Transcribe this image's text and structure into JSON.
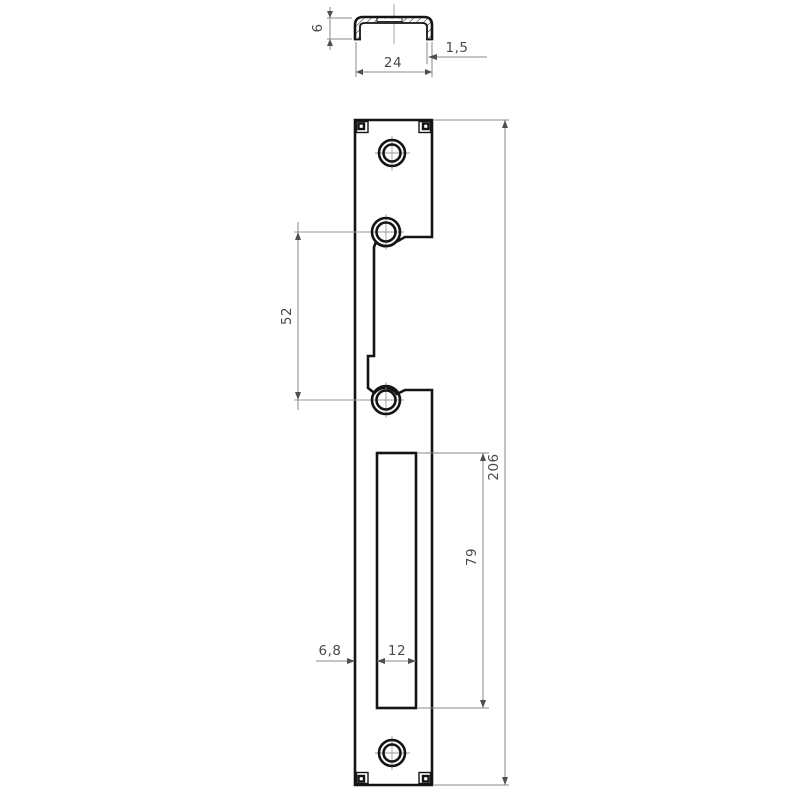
{
  "drawing": {
    "description": "strike-plate technical drawing, two views",
    "section_view": {
      "dim_height": "6",
      "dim_width": "24",
      "dim_wall_thickness": "1,5"
    },
    "front_view": {
      "dim_hole_spacing": "52",
      "dim_total_length": "206",
      "dim_slot_length": "79",
      "dim_slot_offset": "6,8",
      "dim_slot_width": "12"
    }
  },
  "colors": {
    "background": "#ffffff",
    "outline": "#141414",
    "thin_line": "#8a8a8a",
    "dimension_text": "#4a4a4a",
    "arrow": "#4f4f4f"
  }
}
